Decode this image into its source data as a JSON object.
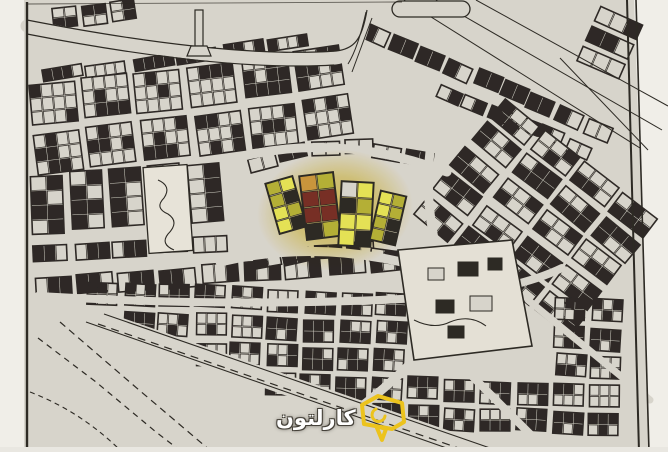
{
  "map": {
    "kind": "scanned-cadastral-city-plan-photo",
    "paper_color": "#d9d5cd",
    "ink_color": "#1b1814",
    "margin_color": "#f4f2ee",
    "plaza_color": "#eae6dc",
    "compound_color": "#e7e3d9",
    "highlight": {
      "glow_color": "#e8c610",
      "olive_parcel_color": "#b2ac28",
      "bright_parcel_color": "#e7e44a",
      "red_parcel_color": "#6e1e15",
      "orange_parcel_color": "#c98f2e"
    }
  },
  "watermark": {
    "text": "كارلتون",
    "text_color": "#ffffff",
    "outline_color": "#46423a",
    "icon": "house-chat-bubble-icon",
    "icon_color": "#ecc31d"
  }
}
